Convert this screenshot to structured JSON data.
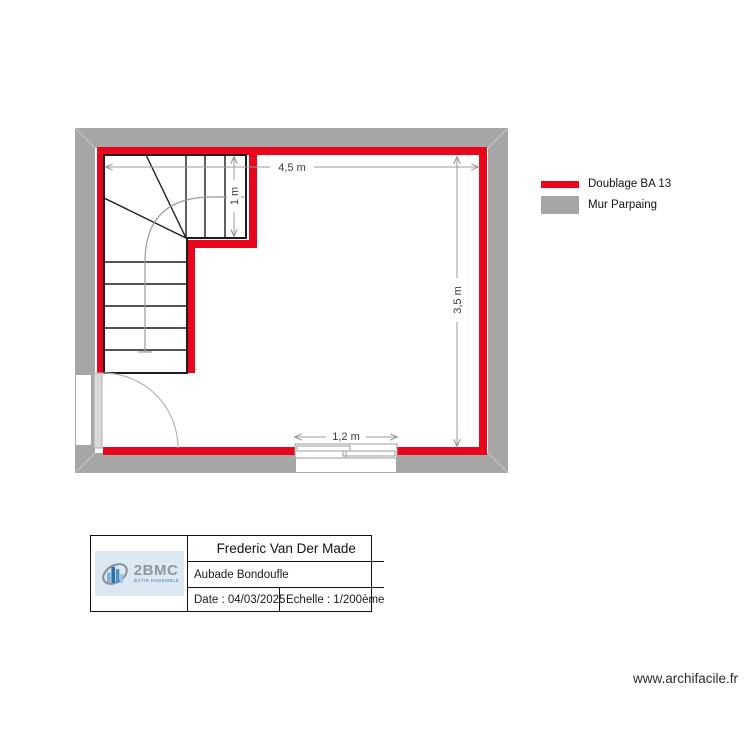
{
  "plan": {
    "dim_top": "4,5 m",
    "dim_stair_width": "1 m",
    "dim_right": "3,5 m",
    "dim_window": "1,2 m"
  },
  "legend": {
    "doublage": {
      "label": "Doublage BA 13",
      "color": "#e8071c"
    },
    "mur": {
      "label": "Mur Parpaing",
      "color": "#a6a6a6"
    }
  },
  "title_block": {
    "name": "Frederic Van Der Made",
    "project": "Aubade Bondoufle",
    "date": "Date : 04/03/2025",
    "scale": "Echelle : 1/200ème"
  },
  "logo": {
    "brand": "2BMC",
    "tagline": "BÂTIR ENSEMBLE"
  },
  "watermark": "www.archifacile.fr"
}
